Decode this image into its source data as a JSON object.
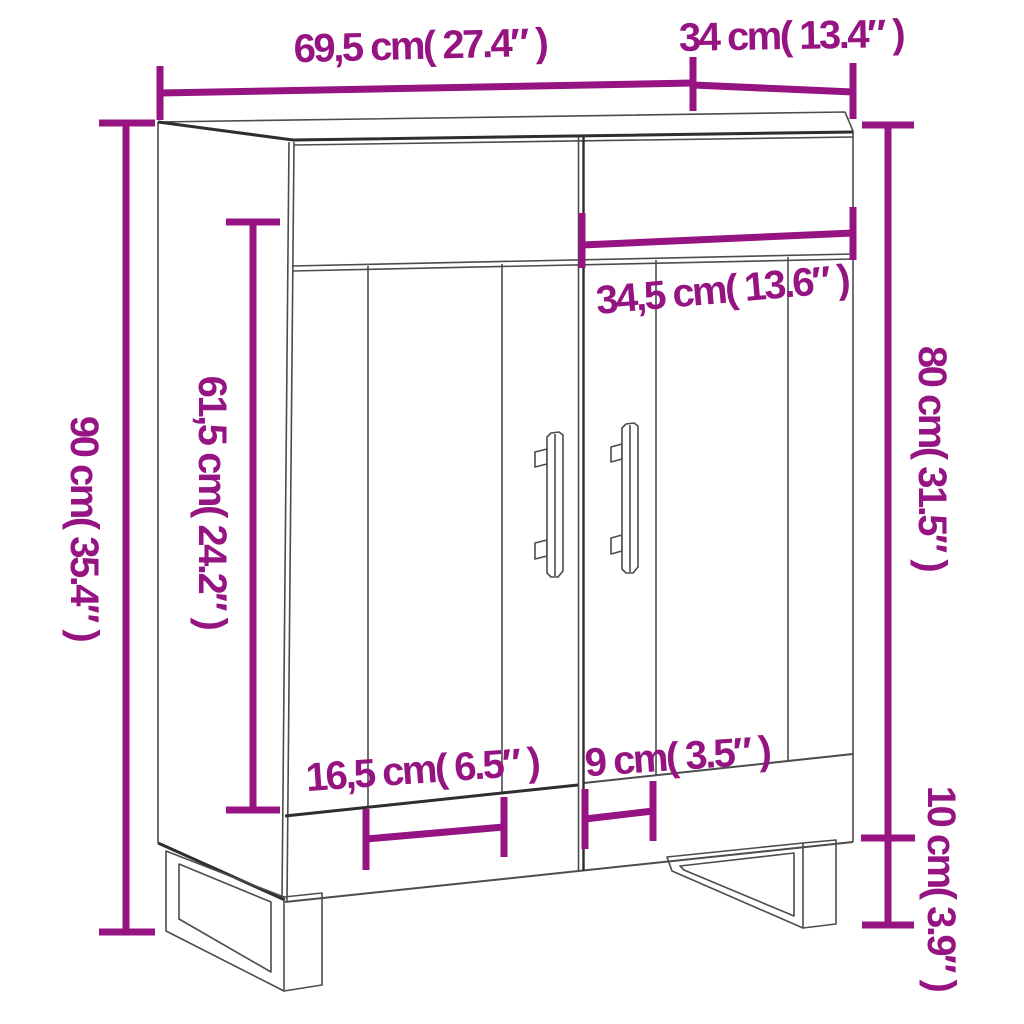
{
  "diagram": {
    "type": "product-dimension-diagram",
    "subject": "sideboard cabinet with two doors, bar handles and U-shaped metal legs",
    "accent_color": "#961482",
    "line_color": "#4c4c4c",
    "background_color": "#ffffff",
    "dimensions": [
      {
        "id": "overall-width",
        "label": "69,5 cm( 27.4″ )",
        "cm": "69,5",
        "inch": "27.4",
        "orientation": "horizontal"
      },
      {
        "id": "overall-depth",
        "label": "34 cm( 13.4″ )",
        "cm": "34",
        "inch": "13.4",
        "orientation": "horizontal"
      },
      {
        "id": "overall-height",
        "label": "90 cm( 35.4″ )",
        "cm": "90",
        "inch": "35.4",
        "orientation": "vertical"
      },
      {
        "id": "door-height",
        "label": "61,5 cm( 24.2″ )",
        "cm": "61,5",
        "inch": "24.2",
        "orientation": "vertical"
      },
      {
        "id": "door-width",
        "label": "34,5 cm( 13.6″ )",
        "cm": "34,5",
        "inch": "13.6",
        "orientation": "horizontal"
      },
      {
        "id": "body-height",
        "label": "80 cm( 31.5″ )",
        "cm": "80",
        "inch": "31.5",
        "orientation": "vertical"
      },
      {
        "id": "leg-inset",
        "label": "16,5 cm( 6.5″ )",
        "cm": "16,5",
        "inch": "6.5",
        "orientation": "horizontal"
      },
      {
        "id": "leg-spacing",
        "label": "9 cm( 3.5″ )",
        "cm": "9",
        "inch": "3.5",
        "orientation": "horizontal"
      },
      {
        "id": "leg-height",
        "label": "10 cm( 3.9″ )",
        "cm": "10",
        "inch": "3.9",
        "orientation": "vertical"
      }
    ]
  }
}
